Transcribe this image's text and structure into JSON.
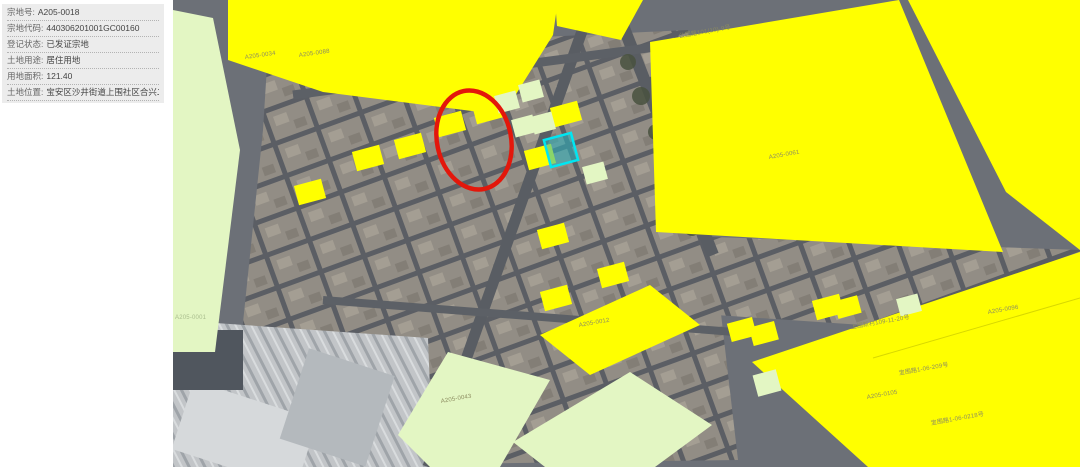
{
  "panel": {
    "rows": [
      {
        "label": "宗地号:",
        "value": "A205-0018"
      },
      {
        "label": "宗地代码:",
        "value": "440306201001GC00160"
      },
      {
        "label": "登记状态:",
        "value": "已发证宗地"
      },
      {
        "label": "土地用途:",
        "value": "居住用地"
      },
      {
        "label": "用地面积:",
        "value": "121.40"
      },
      {
        "label": "土地位置:",
        "value": "宝安区沙井街道上围社区合兴二巷二号"
      }
    ]
  },
  "map": {
    "parcel_labels": [
      {
        "text": "A205-0034"
      },
      {
        "text": "A205-0088"
      },
      {
        "text": "公园路101(10)-9号"
      },
      {
        "text": "A205-0061"
      },
      {
        "text": "A205-0012"
      },
      {
        "text": "A205-0043"
      },
      {
        "text": "A205-0001"
      },
      {
        "text": "上围新村109-11-20号"
      },
      {
        "text": "A205-0096"
      },
      {
        "text": "宝围路1-06-209号"
      },
      {
        "text": "A205-0105"
      },
      {
        "text": "宝围路1-06-0218号"
      }
    ],
    "highlight_name": "selected-parcel",
    "annotation": "selection-circle"
  },
  "colors": {
    "parcel_yellow": "#ffff00",
    "parcel_green": "#e3f6c3",
    "highlight_fill": "#2ab5c0",
    "highlight_stroke": "#00e6f2",
    "circle_red": "#e3170b",
    "label_olive": "#8c8c60"
  }
}
